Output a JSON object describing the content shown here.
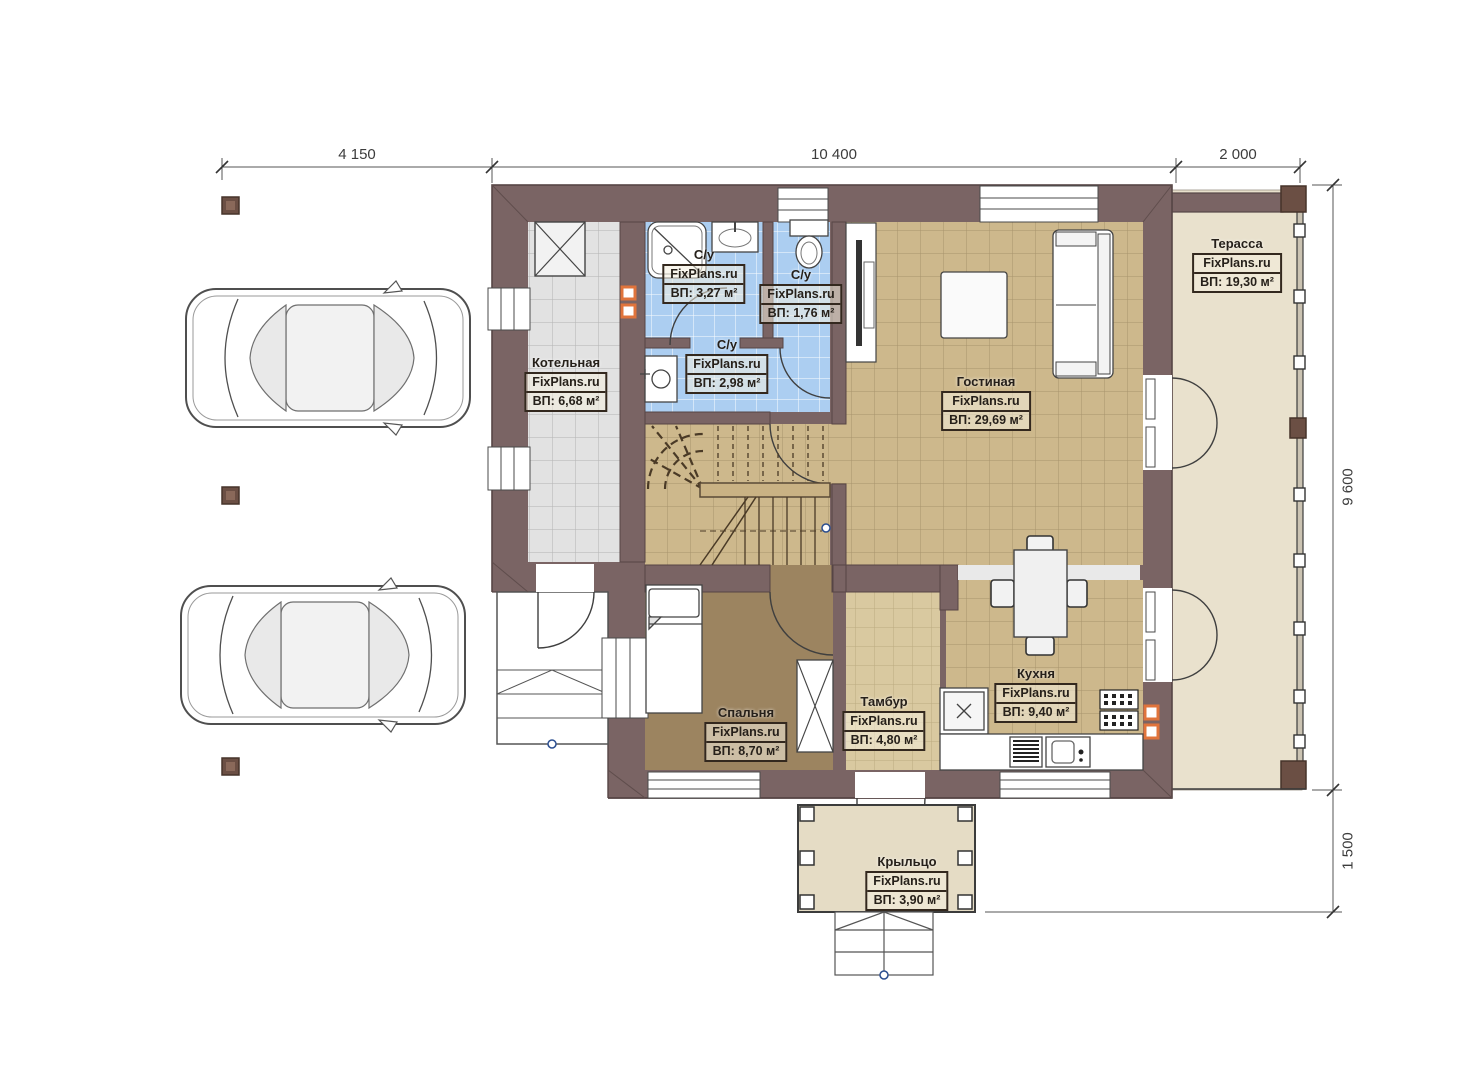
{
  "brand": "FixPlans.ru",
  "plan_title": "План 1 этажа",
  "dimensions": {
    "top": [
      "4 150",
      "10 400",
      "2 000"
    ],
    "right": [
      "9 600",
      "1 500"
    ]
  },
  "rooms": [
    {
      "id": "terrace",
      "name": "Терасса",
      "area": "ВП: 19,30 м²"
    },
    {
      "id": "bath-shower",
      "name": "С/у",
      "area": "ВП: 3,27 м²"
    },
    {
      "id": "bath-wc",
      "name": "С/у",
      "area": "ВП: 1,76 м²"
    },
    {
      "id": "bath-lower",
      "name": "С/у",
      "area": "ВП: 2,98 м²"
    },
    {
      "id": "boiler",
      "name": "Котельная",
      "area": "ВП: 6,68 м²"
    },
    {
      "id": "living",
      "name": "Гостиная",
      "area": "ВП: 29,69 м²"
    },
    {
      "id": "bedroom",
      "name": "Спальня",
      "area": "ВП: 8,70 м²"
    },
    {
      "id": "vestibule",
      "name": "Тамбур",
      "area": "ВП: 4,80 м²"
    },
    {
      "id": "kitchen",
      "name": "Кухня",
      "area": "ВП: 9,40 м²"
    },
    {
      "id": "porch",
      "name": "Крыльцо",
      "area": "ВП: 3,90 м²"
    }
  ],
  "colors": {
    "wall": "#7a6464",
    "wall-dark": "#564545",
    "floor-gray": "#e2e2e2",
    "grid-gray": "#b3b3b3",
    "floor-blue": "#accef1",
    "floor-tan": "#cdb88c",
    "grid-tan": "#a8936c",
    "floor-tan-light": "#d9c9a0",
    "grid-tan-light": "#bcab80",
    "floor-bedroom": "#9c8460",
    "floor-terrace": "#e9e1cd",
    "floor-porch": "#e5dcc5",
    "accent-orange": "#e0743c",
    "landing": "#c9b284",
    "post-brown": "#6b4f44",
    "dim-text": "#3c3c3c"
  }
}
